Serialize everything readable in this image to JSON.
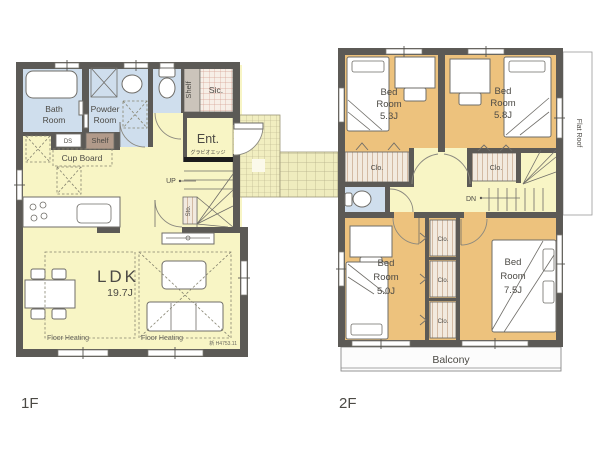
{
  "title": "House floor plan 1F / 2F",
  "colors": {
    "wall": "#5c5a56",
    "floor_yellow": "#f8f5c5",
    "water_blue": "#cfdeed",
    "bedroom_tan": "#edc27d",
    "porch": "#f1eec0",
    "closet_stripe": "#ccae94",
    "balcony": "#fcfcfc"
  },
  "floor1": {
    "label": "1F",
    "bath": {
      "line1": "Bath",
      "line2": "Room"
    },
    "powder": {
      "line1": "Powder",
      "line2": "Room"
    },
    "shelf_top": "Shelf",
    "sic": "Sic.",
    "ent": "Ent.",
    "ent_note": "グラビオエッジ",
    "up": "UP",
    "sto": "Sto.",
    "ds": "DS",
    "shelf_mid": "Shelf",
    "cupboard": "Cup Board",
    "ldk_name": "LDK",
    "ldk_size": "19.7J",
    "floor_heating_left": "Floor Heating",
    "floor_heating_right": "Floor Heating",
    "note": "新 H4753.11"
  },
  "floor2": {
    "label": "2F",
    "bed1": {
      "line1": "Bed",
      "line2": "Room",
      "size": "5.3J"
    },
    "bed2": {
      "line1": "Bed",
      "line2": "Room",
      "size": "5.8J"
    },
    "bed3": {
      "line1": "Bed",
      "line2": "Room",
      "size": "5.0J"
    },
    "bed4": {
      "line1": "Bed",
      "line2": "Room",
      "size": "7.5J"
    },
    "clo1": "Clo.",
    "clo2": "Clo.",
    "clo3": "Clo.",
    "clo4": "Clo.",
    "clo5": "Clo.",
    "dn": "DN",
    "flat_roof": "Flat Roof",
    "balcony": "Balcony"
  }
}
